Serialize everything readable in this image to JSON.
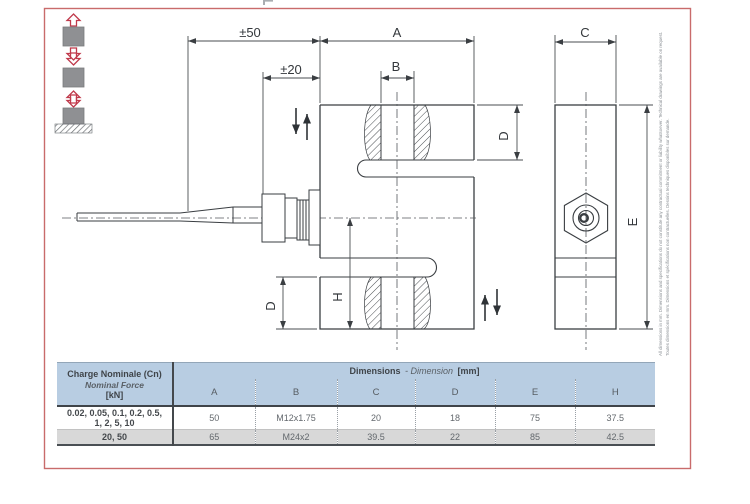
{
  "page": {
    "frame_color": "#c96b6b",
    "line_color": "#3a3e42",
    "background": "#ffffff"
  },
  "icons": [
    {
      "name": "tension-load-icon",
      "description": "gray block with red hollow arrows pulling up and down"
    },
    {
      "name": "compression-load-icon",
      "description": "gray block with red hollow arrows pushing together"
    },
    {
      "name": "ground-compression-icon",
      "description": "gray block on hatched ground with red hollow arrow pressing down"
    }
  ],
  "drawing": {
    "labels": {
      "pm50": "±50",
      "pm20": "±20",
      "A": "A",
      "B": "B",
      "C": "C",
      "D": "D",
      "E": "E",
      "H": "H"
    },
    "disclaimer_fr": "Toutes dimensions en mm. Dimensions et spécifications non contractuelles. Dessins techniques disponibles sur demande.",
    "disclaimer_en": "All dimensions in mm. Dimensions and specifications do not constitute any contractual commitment or liability whatsoever. Technical drawings are available on request."
  },
  "table": {
    "charge": {
      "line1": "Charge Nominale (Cn)",
      "line2": "Nominal Force",
      "line3": "[kN]"
    },
    "dims": {
      "b1": "Dimensions",
      "i1": "- Dimension",
      "b2": "[mm]"
    },
    "columns": [
      "A",
      "B",
      "C",
      "D",
      "E",
      "H"
    ],
    "rows": [
      {
        "label_line1": "0.02, 0.05, 0.1, 0.2, 0.5,",
        "label_line2": "1, 2, 5, 10",
        "values": [
          "50",
          "M12x1.75",
          "20",
          "18",
          "75",
          "37.5"
        ]
      },
      {
        "label": "20, 50",
        "values": [
          "65",
          "M24x2",
          "39.5",
          "22",
          "85",
          "42.5"
        ]
      }
    ],
    "colors": {
      "header_bg": "#b8cde2",
      "alt_row_bg": "#d8d8d8"
    }
  }
}
